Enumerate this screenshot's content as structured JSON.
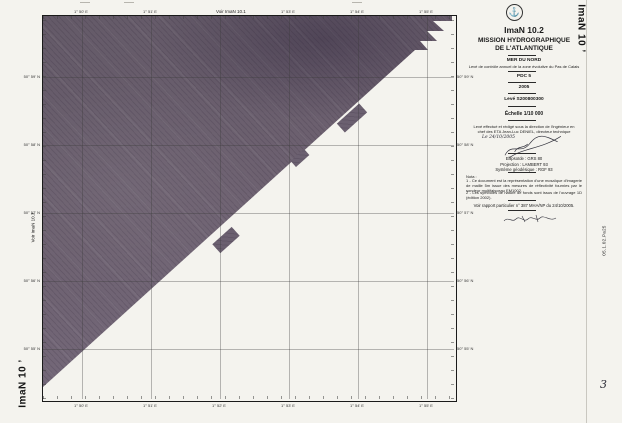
{
  "document_type": "scanned hydrographic survey sheet",
  "margins": {
    "top_reference": "Voir ImaN 10.1",
    "left_reference": "Voir ImaN 10.3",
    "sheet_mark_bottom_left": "ImaN 10 ’",
    "sheet_mark_top_right": "ImaN 10 ’",
    "right_archive_code": "05.1.02.Pa25",
    "bottom_right_number": "3"
  },
  "grid": {
    "lon_labels": [
      "1° 50' E",
      "1° 51' E",
      "1° 52' E",
      "1° 53' E",
      "1° 54' E",
      "1° 55' E"
    ],
    "lat_labels": [
      "50° 59' N",
      "50° 58' N",
      "50° 57' N",
      "50° 56' N",
      "50° 55' N"
    ]
  },
  "title_block": {
    "emblem_icon": "anchor-icon",
    "sheet_id": "ImaN 10.2",
    "mission_line1": "MISSION HYDROGRAPHIQUE",
    "mission_line2": "DE L'ATLANTIQUE",
    "area": "MER DU NORD",
    "subtitle": "Levé de contrôle annuel de la zone évolutive du Pas de Calais",
    "zone": "PDC 5",
    "year": "2005",
    "survey_ref": "Levé S200800300",
    "scale": "Échelle 1/10 000",
    "direction": "Levé effectué et rédigé sous la direction de l'ingénieur en chef des ETA Jean-Luc DENIEL, directeur technique",
    "hand_date": "Le 24/10/2005",
    "geodesy_line1": "Ellipsoïde : GRS 80",
    "geodesy_line2": "Projection : LAMBERT 93",
    "geodesy_line3": "Système géodésique : RGF 93",
    "nota_heading": "Nota :",
    "nota_1": "1 - Ce document est la représentation d'une mosaïque d'imagerie de maille 5m issue des mesures de réflectivité fournies par le sondeur multifaisceau EM1002.",
    "nota_2": "2 - Les symboles de nature de fonds sont issus de l'ouvrage 1D (édition 2002).",
    "report": "Voir rapport particulier n° 387 MHA/NP du 24/10/2005."
  },
  "colors": {
    "paper": "#f4f3ee",
    "mosaic_base": "#6b6070",
    "frame": "#1a1a1a"
  }
}
